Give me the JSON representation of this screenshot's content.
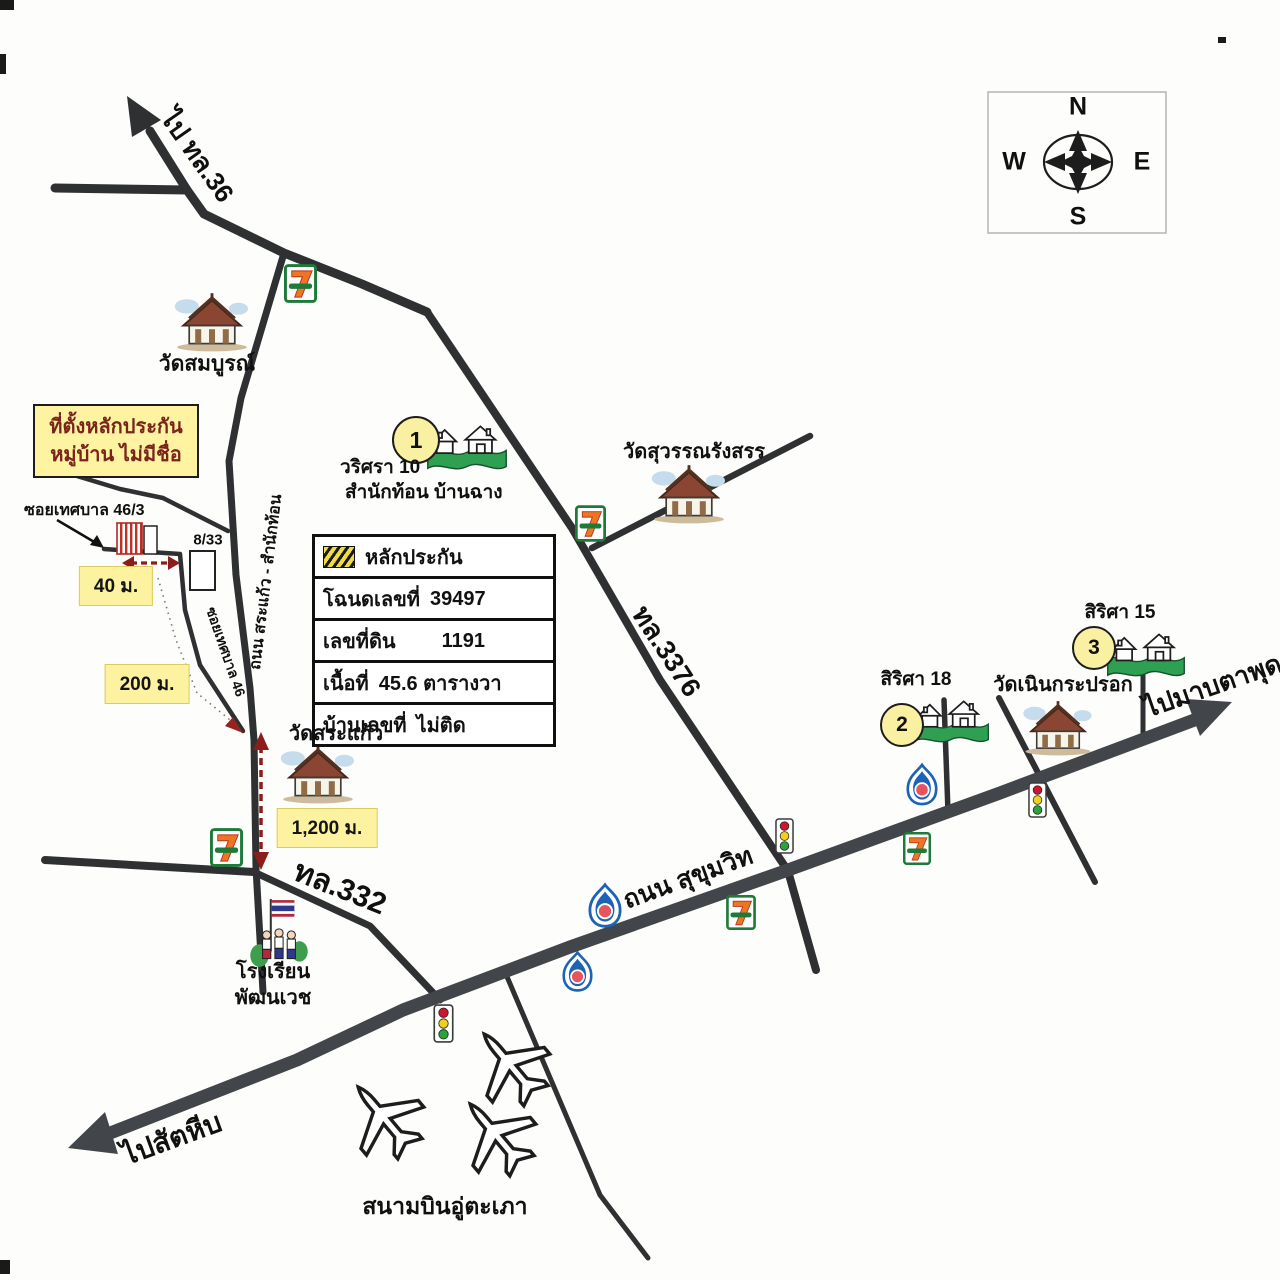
{
  "compass": {
    "north": "N",
    "west": "W",
    "east": "E",
    "south": "S"
  },
  "directions": {
    "to_hwy36": "ไป ทล.36",
    "to_sattahip": "ไปสัตหีบ",
    "to_map_ta_phut": "ไปมาบตาพุด"
  },
  "roads": {
    "sukhumvit": "ถนน สุขุมวิท",
    "hwy_3376": "ทล.3376",
    "hwy_332": "ทล.332",
    "sa_kaew_samnak_thon": "ถนน สระแก้ว - สำนักท้อน",
    "soi_thetsaban_46": "ซอยเทศบาล 46",
    "soi_thetsaban_46_3": "ซอยเทศบาล 46/3"
  },
  "places": {
    "wat_somboon": "วัดสมบูรณ์",
    "wat_suwanrangsan": "วัดสุวรรณรังสรร",
    "wat_sa_kaew": "วัดสระแก้ว",
    "wat_noen_kraprok": "วัดเนินกระปรอก",
    "school_line1": "โรงเรียน",
    "school_line2": "พัฒนเวช",
    "airport": "สนามบินอู่ตะเภา",
    "warisara_10": "วริศรา 10",
    "samnak_thon_ban_chang": "สำนักท้อน บ้านฉาง",
    "sirisa_18": "สิริศา 18",
    "sirisa_15": "สิริศา 15",
    "house_no": "8/33"
  },
  "markers": {
    "no1": "1",
    "no2": "2",
    "no3": "3"
  },
  "distances": {
    "d40": "40 ม.",
    "d200": "200 ม.",
    "d1200": "1,200 ม."
  },
  "collateral_title_box": {
    "line1": "ที่ตั้งหลักประกัน",
    "line2": "หมู่บ้าน ไม่มีชื่อ"
  },
  "collateral_info_box": {
    "title": "หลักประกัน",
    "rows": [
      {
        "label": "โฉนดเลขที่",
        "value": "39497"
      },
      {
        "label": "เลขที่ดิน",
        "value": "1191"
      },
      {
        "label": "เนื้อที่",
        "value": "45.6 ตารางวา"
      },
      {
        "label": "บ้านเลขที่",
        "value": "ไม่ติด"
      }
    ]
  },
  "icons": {
    "seven_eleven": "7-ELEVEN store",
    "ptt_station": "PTT gas station",
    "traffic_light": "traffic light",
    "temple": "Thai temple",
    "housing_estate": "housing estate",
    "airplane": "airplane",
    "school": "school flag and children",
    "compass_rose": "compass rose"
  },
  "colors": {
    "road": "#2e3032",
    "sukhumvit_road": "#42464a",
    "yellow_highlight": "#fcf2a0",
    "maroon_accent": "#8b1d1d",
    "estate_green": "#2fa052",
    "seven_green": "#1d7a38",
    "ptt_blue": "#1d63b5",
    "ptt_red": "#e85360"
  }
}
